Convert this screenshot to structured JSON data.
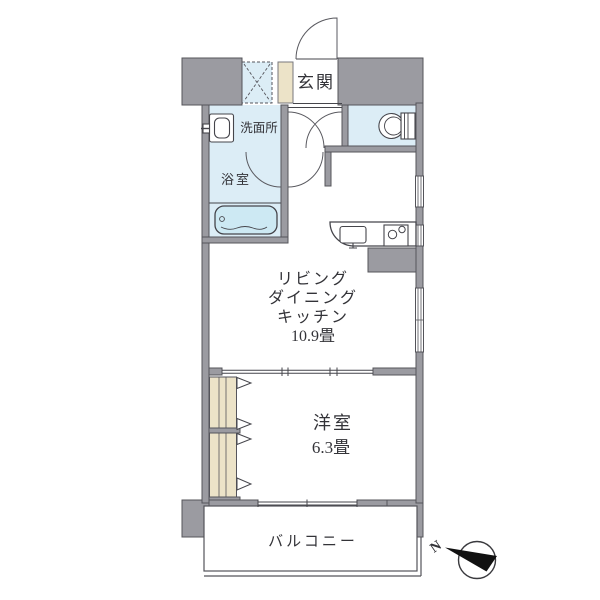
{
  "colors": {
    "wall": "#9b9ba1",
    "wall_outline": "#54545a",
    "water_room": "#dcedf6",
    "tub": "#cde9f3",
    "wood": "#ece3c8",
    "line": "#45454b",
    "text": "#333338",
    "floor": "#ffffff"
  },
  "rooms": {
    "entrance": {
      "label": "玄関"
    },
    "washroom": {
      "label": "洗面所"
    },
    "bathroom": {
      "label": "浴室"
    },
    "ldk": {
      "label_line1": "リビング",
      "label_line2": "ダイニング",
      "label_line3": "キッチン",
      "size": "10.9畳"
    },
    "bedroom": {
      "label": "洋室",
      "size": "6.3畳"
    },
    "balcony": {
      "label": "バルコニー"
    }
  },
  "compass": {
    "north_label": "N"
  }
}
